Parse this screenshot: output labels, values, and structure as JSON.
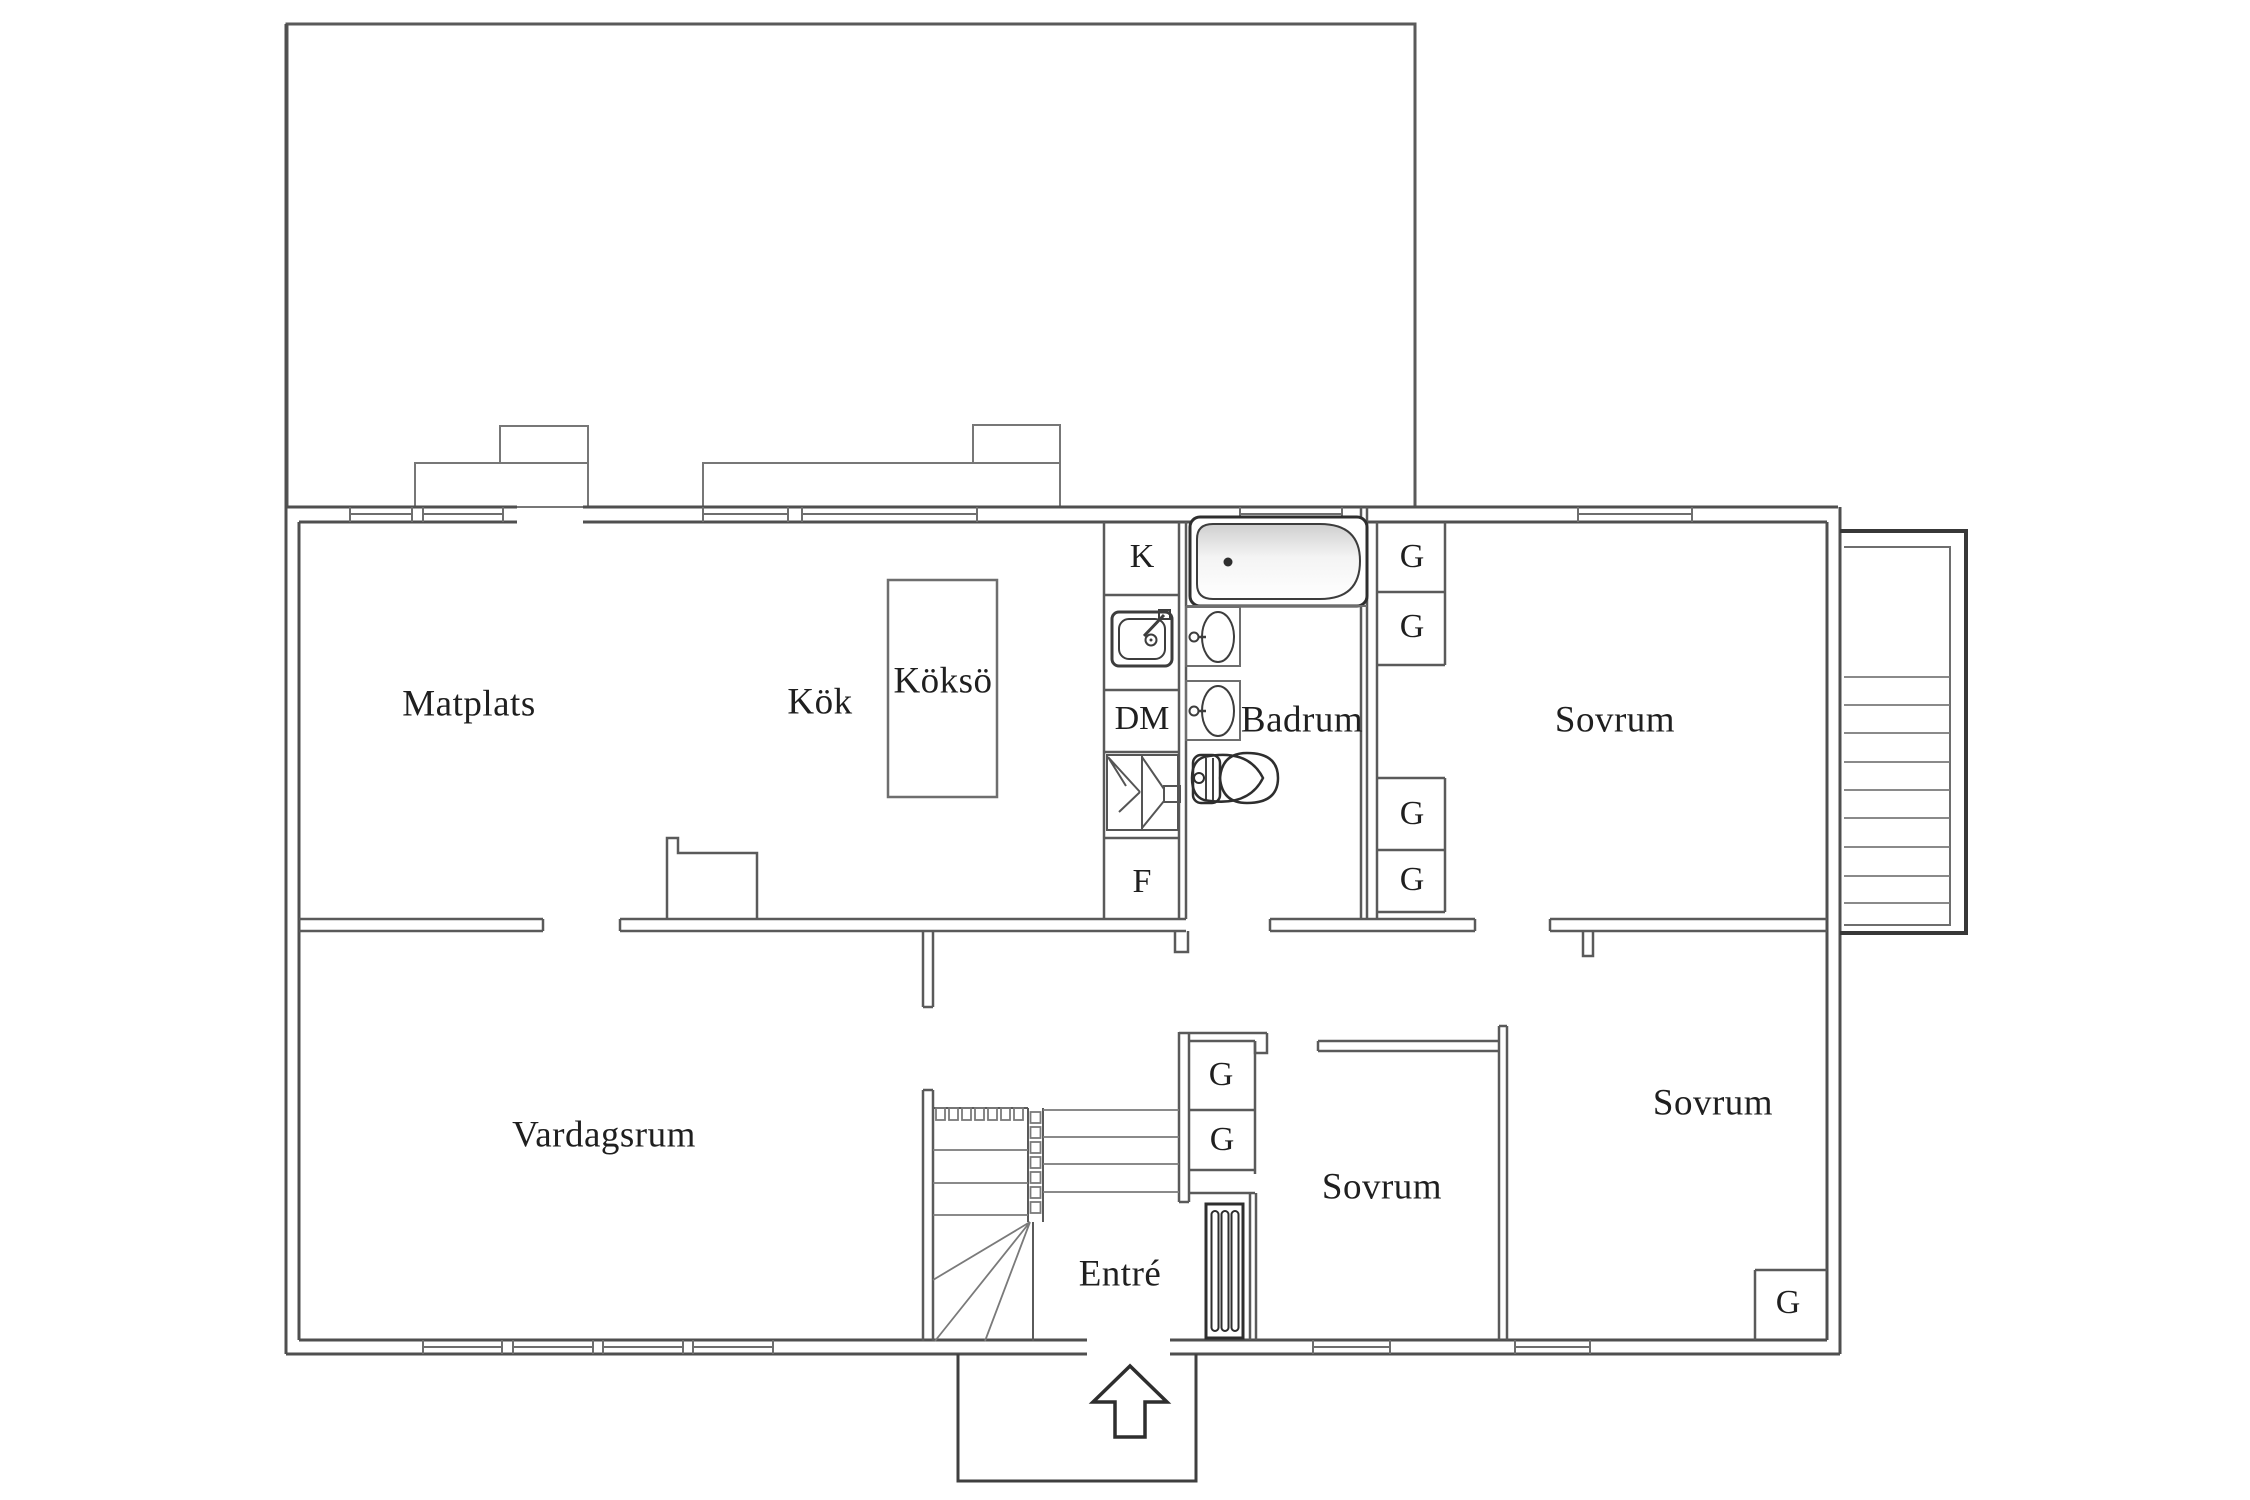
{
  "plan": {
    "rooms": [
      {
        "id": "matplats",
        "label": "Matplats"
      },
      {
        "id": "kok",
        "label": "Kök"
      },
      {
        "id": "vardagsrum",
        "label": "Vardagsrum"
      },
      {
        "id": "badrum",
        "label": "Badrum"
      },
      {
        "id": "sovrum-ovre",
        "label": "Sovrum"
      },
      {
        "id": "sovrum-mitt",
        "label": "Sovrum"
      },
      {
        "id": "sovrum-hoger",
        "label": "Sovrum"
      },
      {
        "id": "entre",
        "label": "Entré"
      }
    ],
    "island": {
      "label": "Köksö"
    },
    "appliances": {
      "fridge": "K",
      "dishwasher": "DM",
      "freezer": "F"
    },
    "wardrobes": [
      {
        "label": "G"
      },
      {
        "label": "G"
      },
      {
        "label": "G"
      },
      {
        "label": "G"
      },
      {
        "label": "G"
      },
      {
        "label": "G"
      },
      {
        "label": "G"
      }
    ],
    "icons": [
      "bathtub-icon",
      "washbasin-icon",
      "washbasin-icon",
      "toilet-icon",
      "kitchen-sink-icon",
      "cabinet-carousel-icon",
      "radiator-icon",
      "staircase-main",
      "staircase-exterior",
      "entrance-arrow-icon"
    ]
  },
  "colors": {
    "background": "#ffffff",
    "wall": "#4f4f4f",
    "wall_thin": "#6e6e6e",
    "wall_dark": "#383838",
    "tread": "#7a7a7a",
    "text": "#1f1f1f",
    "tub_shade": "#cfcfcf"
  }
}
